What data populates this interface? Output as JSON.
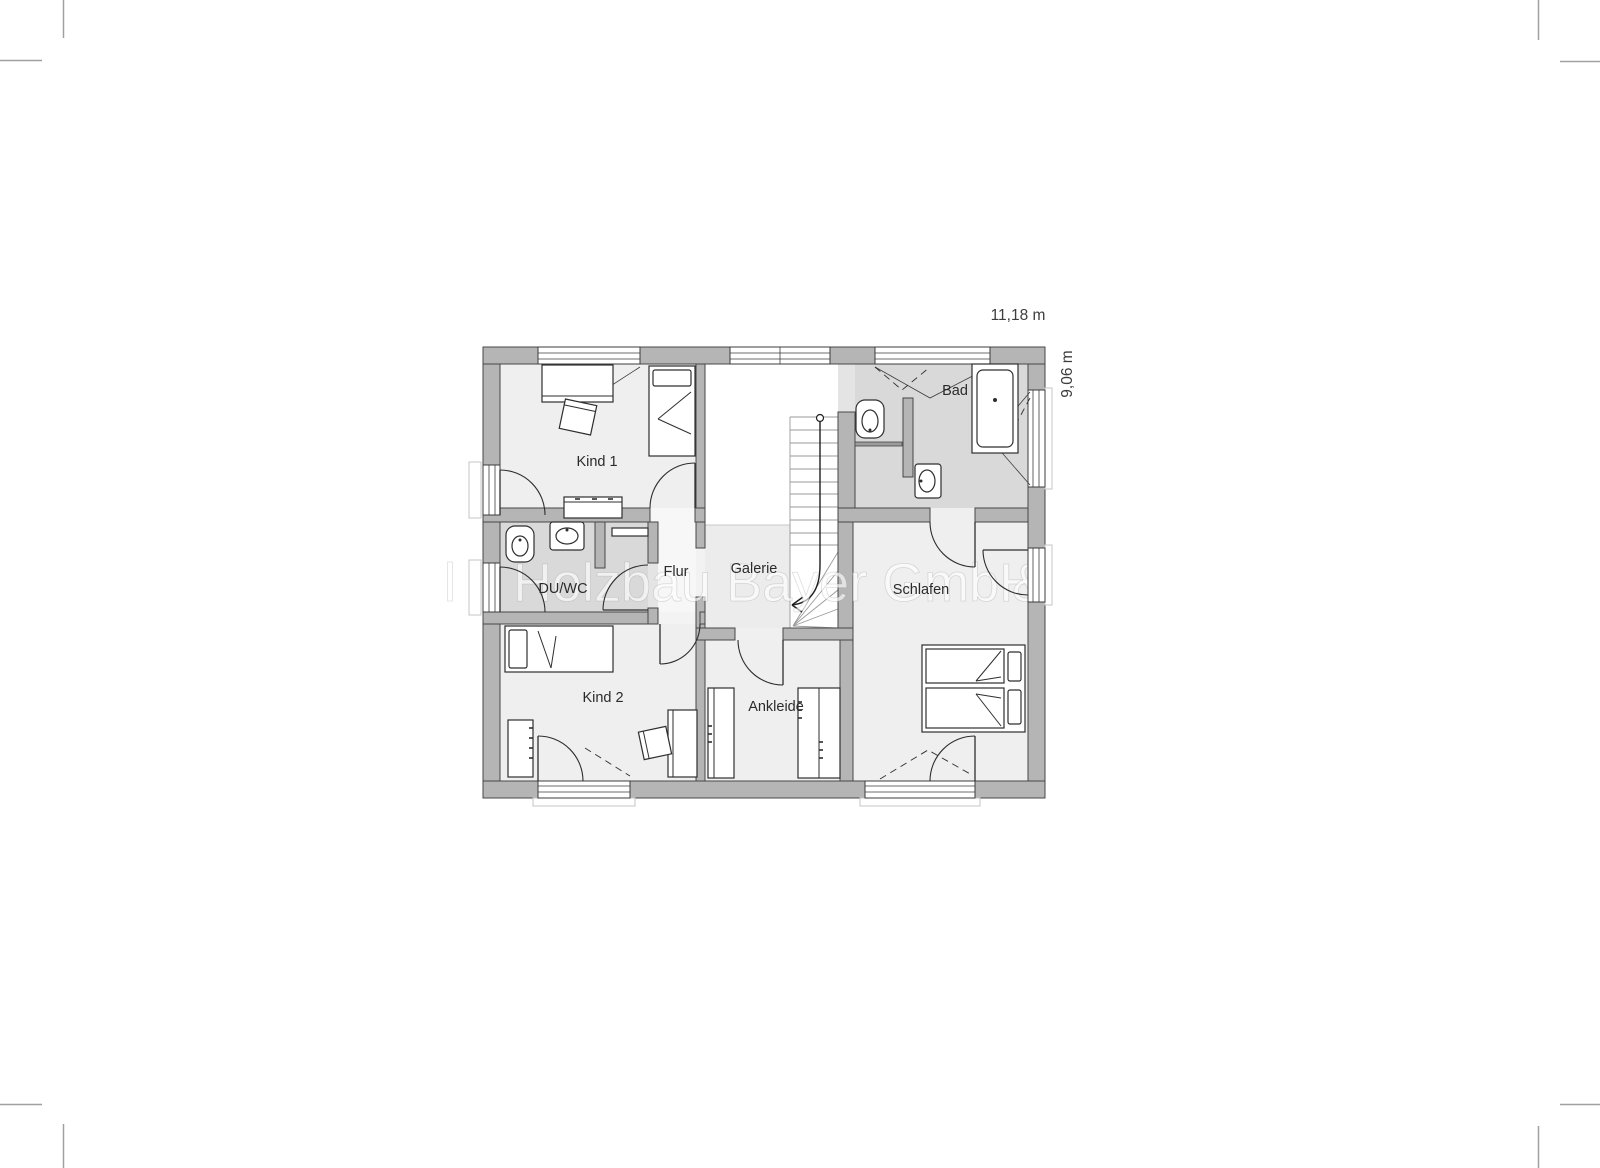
{
  "page": {
    "width": 1600,
    "height": 1168,
    "background": "#ffffff"
  },
  "dimensions": {
    "width_label": "11,18 m",
    "height_label": "9,06 m"
  },
  "watermark": {
    "leading_fragment": "l",
    "text": "Holzbau Bayer GmbH",
    "suffix": "&"
  },
  "rooms": {
    "kind1": {
      "label": "Kind 1"
    },
    "kind2": {
      "label": "Kind 2"
    },
    "duwc": {
      "label": "DU/WC"
    },
    "flur": {
      "label": "Flur"
    },
    "galerie": {
      "label": "Galerie"
    },
    "bad": {
      "label": "Bad"
    },
    "schlafen": {
      "label": "Schlafen"
    },
    "ankleide": {
      "label": "Ankleide"
    }
  },
  "colors": {
    "wall": "#b5b5b5",
    "wall_outline": "#474747",
    "room_light": "#efefef",
    "room_gray": "#d9d9d9",
    "flur_floor": "#f7f7f7",
    "galerie_floor": "#ececec",
    "stairwell_void": "#ffffff",
    "drawing_line": "#2e2e2e",
    "dimension_text": "#3d3d3d",
    "crop_mark": "#a0a0a0",
    "watermark_fill": "rgba(255,255,255,0.62)"
  }
}
